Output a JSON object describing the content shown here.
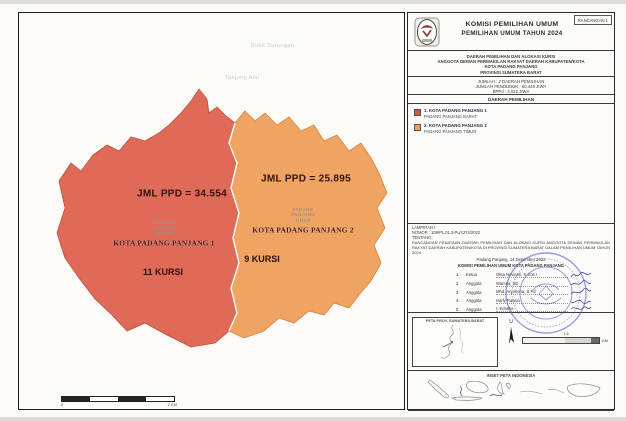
{
  "colors": {
    "region1_fill": "#e06a58",
    "region1_edge": "#c14f3e",
    "region2_fill": "#f0a462",
    "region2_edge": "#d08642",
    "stamp_blue": "#4353c0"
  },
  "map": {
    "region1": {
      "jml_ppd": "JML PPD = 34.554",
      "kecamatan_lines": [
        "PADANG",
        "PANJANG",
        "BARAT"
      ],
      "name": "KOTA PADANG PANJANG 1",
      "kursi": "11 KURSI"
    },
    "region2": {
      "jml_ppd": "JML PPD = 25.895",
      "kecamatan_lines": [
        "PADANG",
        "PANJANG",
        "TIMUR"
      ],
      "name": "KOTA PADANG PANJANG 2",
      "kursi": "9 KURSI"
    },
    "faint_labels": [
      "Bukit Surungan",
      "Tanjung Alai"
    ],
    "scalebar": {
      "left_label": "0",
      "right_label": "2 KM"
    }
  },
  "panel": {
    "draft_tag": "RANCANGAN 1",
    "org_title": "KOMISI PEMILIHAN UMUM",
    "event_title": "PEMILIHAN UMUM TAHUN 2024",
    "subtitle": [
      "DAERAH PEMILIHAN DAN ALOKASI KURSI",
      "ANGGOTA DEWAN PERWAKILAN RAKYAT DAERAH KABUPATEN/KOTA",
      "KOTA PADANG PANJANG",
      "PROVINSI SUMATERA BARAT"
    ],
    "stats": [
      "JUMLAH : 2 DAERAH PEMILIHAN",
      "JUMLAH PENDUDUK : 60.449 JIWA",
      "BPPd : 3.022 JIWA"
    ],
    "section_daerah": "DAERAH PEMILIHAN",
    "dapil": [
      {
        "no": "1.",
        "name": "1. KOTA PADANG PANJANG 1",
        "kecamatan": "PADANG PANJANG BARAT"
      },
      {
        "no": "2.",
        "name": "2. KOTA PADANG PANJANG 2",
        "kecamatan": "PADANG PANJANG TIMUR"
      }
    ],
    "lampiran": {
      "line1": "LAMPIRAN I :",
      "line2": "NOMOR : 109/PL.01.3-Pu/1374/2022",
      "line3": "TENTANG :",
      "body": "RANCANGAN PENATAAN DAERAH PEMILIHAN DAN ALOKASI KURSI ANGGOTA DEWAN PERWAKILAN RAKYAT DAERAH KABUPATEN/KOTA DI PROVINSI SUMATERA BARAT DALAM PEMILIHAN UMUM TAHUN 2024"
    },
    "signing": {
      "place_date": "Padang Panjang, 14 Desember 2022",
      "org": "KOMISI PEMILIHAN UMUM KOTA PADANG PANJANG",
      "members": [
        {
          "no": "1.",
          "role": "Ketua",
          "name": "Okta Novianti, S.Sos.I"
        },
        {
          "no": "2.",
          "role": "Anggota",
          "name": "Warnita, SE"
        },
        {
          "no": "3.",
          "role": "Anggota",
          "name": "Mhd. Aryahona, S.Pd"
        },
        {
          "no": "4.",
          "role": "Anggota",
          "name": "Harly Rawan"
        },
        {
          "no": "5.",
          "role": "Anggota",
          "name": "I. Ednelia"
        }
      ]
    },
    "insets": {
      "sumbar_label": "PETA PROV. SUMATERA BARAT",
      "north_label": "U",
      "scale_value": "1.6",
      "scale_unit": "KM",
      "indonesia_label": "INSET PETA INDONESIA"
    }
  }
}
